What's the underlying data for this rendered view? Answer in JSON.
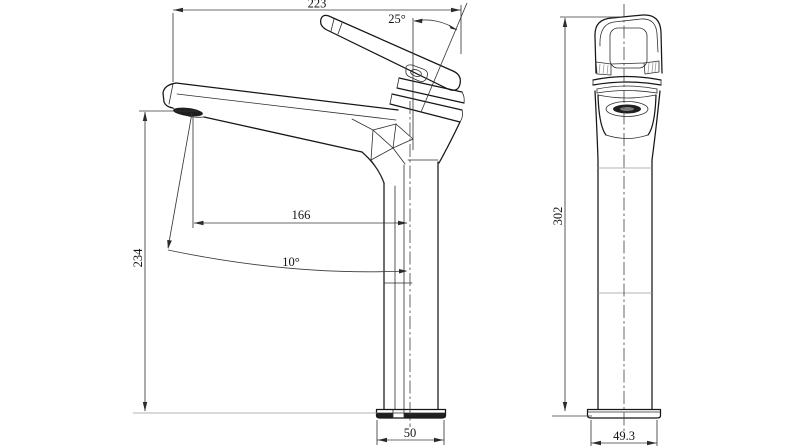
{
  "page": {
    "background_color": "#ffffff"
  },
  "drawing": {
    "type": "technical-orthographic-views",
    "line_color": "#161616",
    "dim_color": "#3a3a3a",
    "thin_line_color": "#9a9a9a",
    "side_view": {
      "dimensions": {
        "overall_width": "223",
        "handle_angle": "25°",
        "spout_height": "234",
        "spout_reach": "166",
        "spout_tilt": "10°",
        "base_width": "50"
      }
    },
    "front_view": {
      "dimensions": {
        "overall_height": "302",
        "base_width": "49.3"
      }
    }
  }
}
